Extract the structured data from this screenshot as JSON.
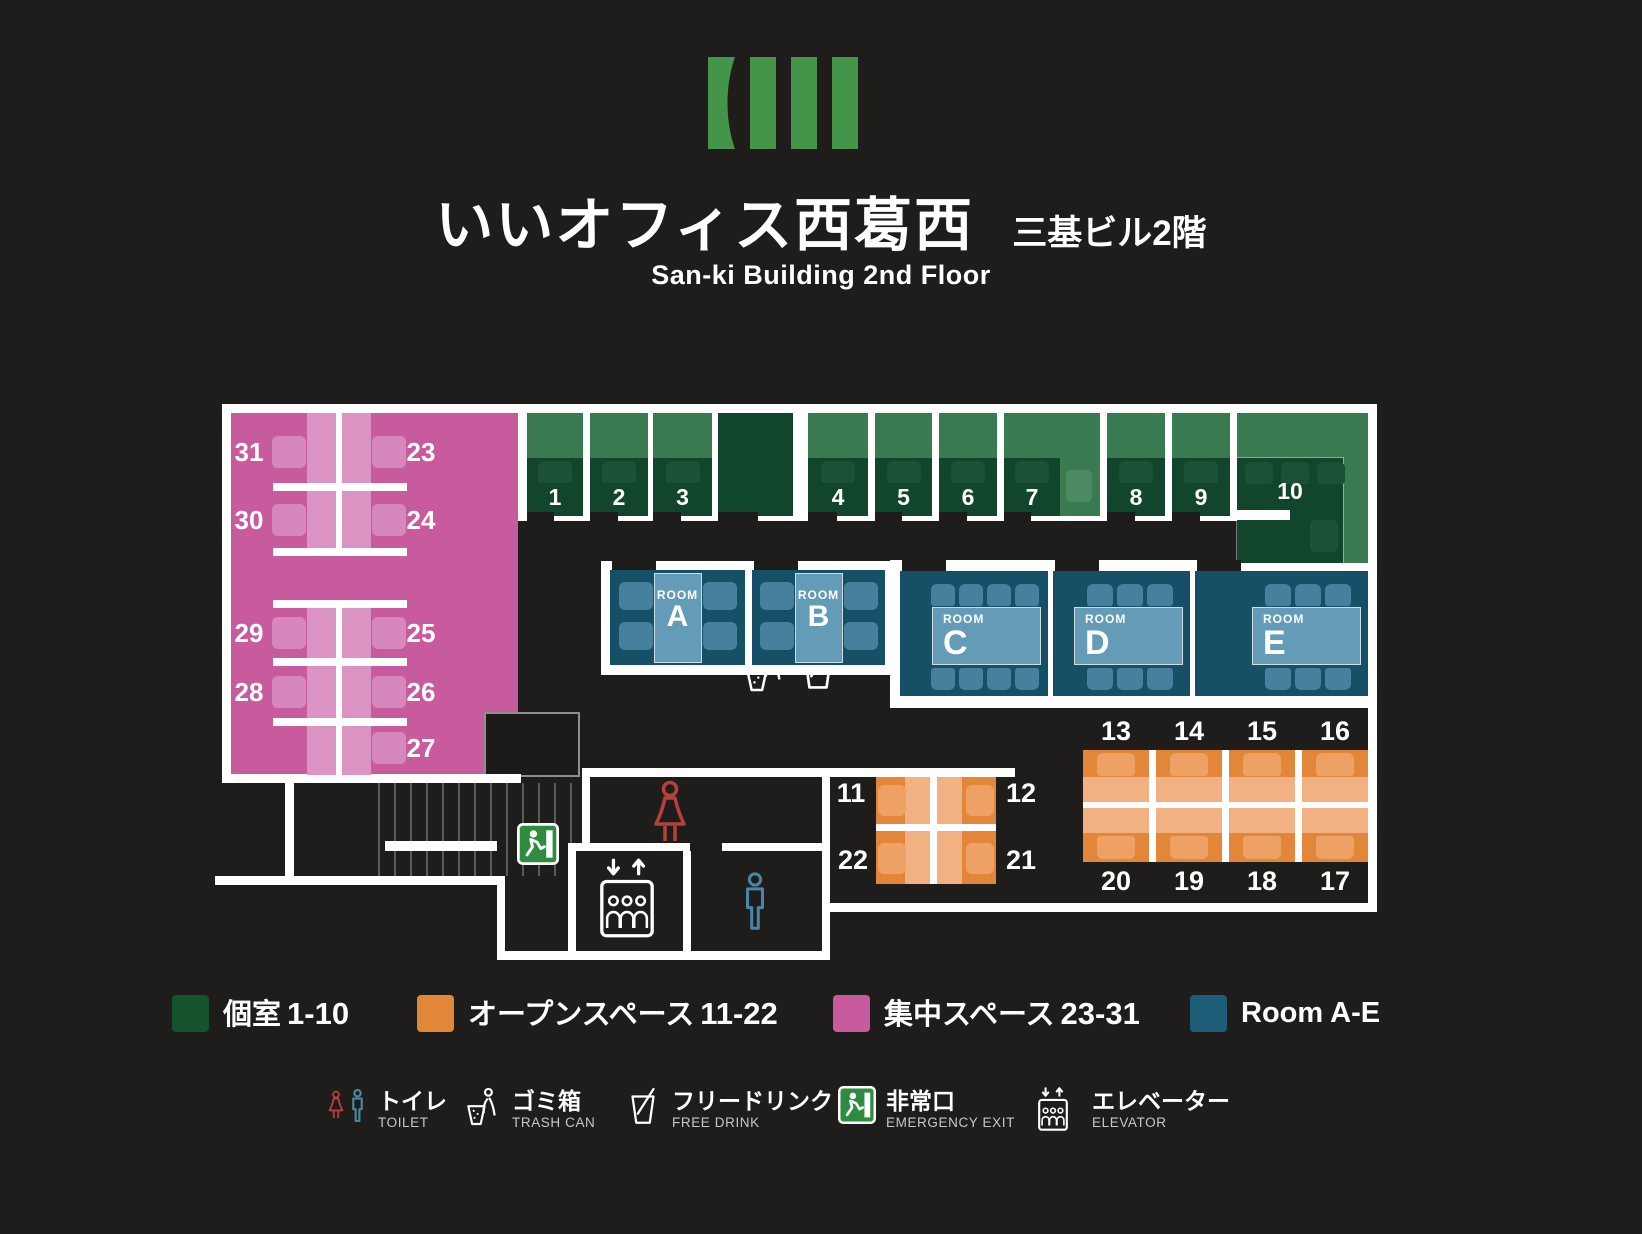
{
  "header": {
    "title_ja": "いいオフィス西葛西",
    "title_sub_ja": "三基ビル2階",
    "subtitle_en": "San-ki Building 2nd Floor"
  },
  "colors": {
    "bg": "#1f1d1b",
    "wall": "#ffffff",
    "pink": "#c85a9e",
    "pink_strip": "#db93c3",
    "pink_chair": "#d687bb",
    "green_light": "#3a7a50",
    "green_dark": "#12462c",
    "green_chair": "#1d5136",
    "green_open_chair": "#4d8a63",
    "blue_room": "#155066",
    "blue_chair": "#46809c",
    "blue_table": "#649cb8",
    "orange": "#e2873a",
    "orange_desk": "#f2b183",
    "orange_chair": "#eda164",
    "legend_green": "#14532d",
    "legend_blue": "#1d5d77",
    "red_icon": "#b5413c",
    "blue_icon": "#4987a8",
    "exit_green": "#2e8b40"
  },
  "plan": {
    "booths": [
      {
        "label": "1",
        "x": 527,
        "w": 56,
        "type": "booth"
      },
      {
        "label": "2",
        "x": 590,
        "w": 58,
        "type": "booth"
      },
      {
        "label": "3",
        "x": 653,
        "w": 59,
        "type": "booth"
      },
      {
        "label": "",
        "x": 718,
        "w": 75,
        "type": "alcove"
      },
      {
        "label": "4",
        "x": 808,
        "w": 60,
        "type": "booth"
      },
      {
        "label": "5",
        "x": 875,
        "w": 57,
        "type": "booth"
      },
      {
        "label": "6",
        "x": 939,
        "w": 58,
        "type": "booth"
      },
      {
        "label": "7",
        "x": 1004,
        "w": 56,
        "type": "booth"
      },
      {
        "label": "",
        "x": 1060,
        "w": 40,
        "type": "open"
      },
      {
        "label": "8",
        "x": 1107,
        "w": 58,
        "type": "booth"
      },
      {
        "label": "9",
        "x": 1172,
        "w": 58,
        "type": "booth"
      },
      {
        "label": "10",
        "x": 1237,
        "w": 131,
        "type": "booth10"
      }
    ],
    "focus_rows": [
      {
        "left": "31",
        "right": "23",
        "y": 452
      },
      {
        "left": "30",
        "right": "24",
        "y": 520
      },
      {
        "left": "29",
        "right": "25",
        "y": 633
      },
      {
        "left": "28",
        "right": "26",
        "y": 692
      },
      {
        "left": "",
        "right": "27",
        "y": 748
      }
    ],
    "meeting_rooms": [
      {
        "tag": "ROOM",
        "letter": "A",
        "x": 610,
        "w": 135,
        "kind": "v"
      },
      {
        "tag": "ROOM",
        "letter": "B",
        "x": 752,
        "w": 133,
        "kind": "v"
      },
      {
        "tag": "ROOM",
        "letter": "C",
        "x": 900,
        "w": 148,
        "kind": "h",
        "chairs": 4
      },
      {
        "tag": "ROOM",
        "letter": "D",
        "x": 1053,
        "w": 137,
        "kind": "h",
        "chairs": 3
      },
      {
        "tag": "ROOM",
        "letter": "E",
        "x": 1195,
        "w": 173,
        "kind": "h",
        "chairs": 3
      }
    ],
    "open_left": {
      "labels": [
        [
          "11",
          "12"
        ],
        [
          "22",
          "21"
        ]
      ]
    },
    "open_right": {
      "top": [
        "13",
        "14",
        "15",
        "16"
      ],
      "bottom": [
        "20",
        "19",
        "18",
        "17"
      ]
    }
  },
  "legend": {
    "zones": [
      {
        "color": "#14532d",
        "label": "個室",
        "range": "1-10"
      },
      {
        "color": "#e2873a",
        "label": "オープンスペース",
        "range": "11-22"
      },
      {
        "color": "#c85a9e",
        "label": "集中スペース",
        "range": "23-31"
      },
      {
        "color": "#1d5d77",
        "label": "Room A-E",
        "range": ""
      }
    ],
    "facilities": [
      {
        "icon": "toilet",
        "ja": "トイレ",
        "en": "TOILET"
      },
      {
        "icon": "trash",
        "ja": "ゴミ箱",
        "en": "TRASH CAN"
      },
      {
        "icon": "drink",
        "ja": "フリードリンク",
        "en": "FREE DRINK"
      },
      {
        "icon": "exit",
        "ja": "非常口",
        "en": "EMERGENCY EXIT"
      },
      {
        "icon": "elevator",
        "ja": "エレベーター",
        "en": "ELEVATOR"
      }
    ]
  }
}
